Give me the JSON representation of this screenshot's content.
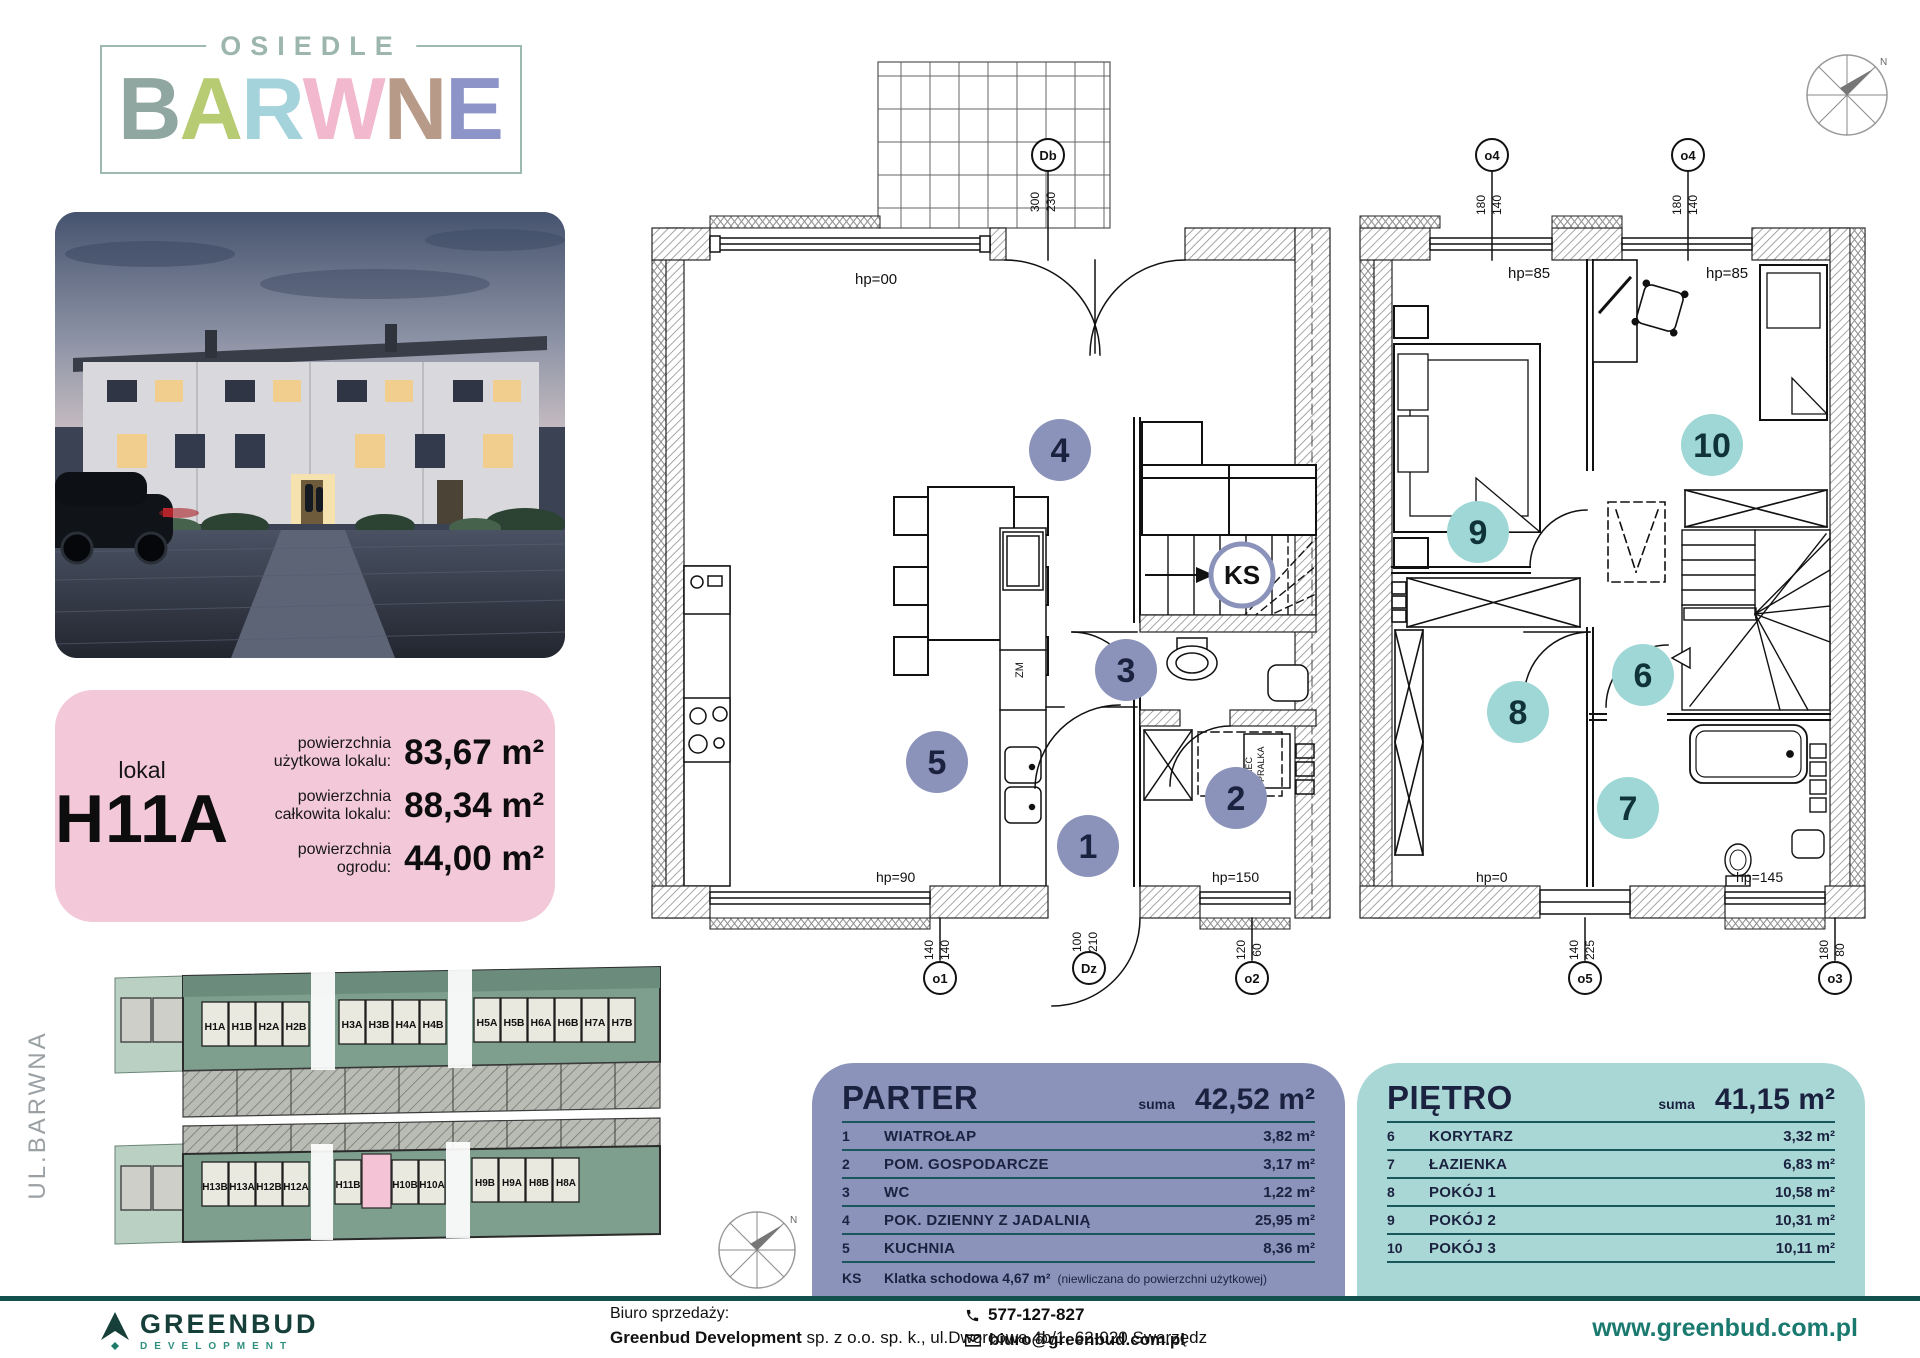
{
  "logo": {
    "osiedle": "OSIEDLE",
    "letters": [
      {
        "t": "B",
        "c": "#8fa7a0"
      },
      {
        "t": "A",
        "c": "#b6cb72"
      },
      {
        "t": "R",
        "c": "#a5d3dc"
      },
      {
        "t": "W",
        "c": "#f1b8ce"
      },
      {
        "t": "N",
        "c": "#b89a88"
      },
      {
        "t": "E",
        "c": "#8d94c8"
      }
    ]
  },
  "card": {
    "lokal": "lokal",
    "unit": "H11A",
    "rows": [
      {
        "l1": "powierzchnia",
        "l2": "użytkowa lokalu:",
        "v": "83,67 m²"
      },
      {
        "l1": "powierzchnia",
        "l2": "całkowita lokalu:",
        "v": "88,34 m²"
      },
      {
        "l1": "powierzchnia",
        "l2": "ogrodu:",
        "v": "44,00 m²"
      }
    ]
  },
  "site": {
    "street": "UL.BARWNA",
    "top": [
      "H1A",
      "H1B",
      "H2A",
      "H2B",
      "H3A",
      "H3B",
      "H4A",
      "H4B",
      "H5A",
      "H5B",
      "H6A",
      "H6B",
      "H7A",
      "H7B"
    ],
    "bottom": [
      "H13B",
      "H13A",
      "H12B",
      "H12A",
      "H11B",
      "H10B",
      "H10A",
      "H9B",
      "H9A",
      "H8B",
      "H8A"
    ],
    "highlight_unit": "H11A"
  },
  "parter_plan": {
    "hp_top": "hp=00",
    "hp_bl": "hp=90",
    "hp_br": "hp=150",
    "db": "Db",
    "db_w": "300",
    "db_h": "230",
    "o1": "o1",
    "o1_w": "140",
    "o1_h": "140",
    "dz": "Dz",
    "dz_w": "100",
    "dz_h": "210",
    "o2": "o2",
    "o2_w": "120",
    "o2_h": "60",
    "r1": "1",
    "r2": "2",
    "r3": "3",
    "r4": "4",
    "r5": "5",
    "ks": "KS",
    "zm": "ZM",
    "pralka": "PRALKA",
    "piec": "PIEC"
  },
  "pietro_plan": {
    "o4": "o4",
    "o4_w": "180",
    "o4_h": "140",
    "hp_tl": "hp=85",
    "hp_tr": "hp=85",
    "hp_bl": "hp=0",
    "hp_br": "hp=145",
    "o5": "o5",
    "o5_w": "140",
    "o5_h": "225",
    "o3": "o3",
    "o3_w": "180",
    "o3_h": "80",
    "r6": "6",
    "r7": "7",
    "r8": "8",
    "r9": "9",
    "r10": "10",
    "n": "N"
  },
  "tables": {
    "parter": {
      "title": "PARTER",
      "suma_label": "suma",
      "suma": "42,52 m²",
      "rows": [
        {
          "no": "1",
          "name": "WIATROŁAP",
          "area": "3,82 m²"
        },
        {
          "no": "2",
          "name": "POM. GOSPODARCZE",
          "area": "3,17 m²"
        },
        {
          "no": "3",
          "name": "WC",
          "area": "1,22 m²"
        },
        {
          "no": "4",
          "name": "POK. DZIENNY Z JADALNIĄ",
          "area": "25,95 m²"
        },
        {
          "no": "5",
          "name": "KUCHNIA",
          "area": "8,36 m²"
        }
      ],
      "ks_no": "KS",
      "ks_name": "Klatka schodowa 4,67 m²",
      "ks_note": "(niewliczana do powierzchni użytkowej)"
    },
    "pietro": {
      "title": "PIĘTRO",
      "suma_label": "suma",
      "suma": "41,15 m²",
      "rows": [
        {
          "no": "6",
          "name": "KORYTARZ",
          "area": "3,32 m²"
        },
        {
          "no": "7",
          "name": "ŁAZIENKA",
          "area": "6,83 m²"
        },
        {
          "no": "8",
          "name": "POKÓJ 1",
          "area": "10,58 m²"
        },
        {
          "no": "9",
          "name": "POKÓJ 2",
          "area": "10,31 m²"
        },
        {
          "no": "10",
          "name": "POKÓJ 3",
          "area": "10,11 m²"
        }
      ]
    }
  },
  "footer": {
    "brand": "GREENBUD",
    "brand_sub": "DEVELOPMENT",
    "office_label": "Biuro sprzedaży:",
    "company": "Greenbud Development",
    "company_rest": " sp. z o.o. sp. k., ul.Dworcowa 4b/1, 62-020 Swarzędz",
    "phone": "577-127-827",
    "email": "biuro@greenbud.com.pl",
    "website": "www.greenbud.com.pl"
  },
  "colors": {
    "pink_card": "#f3c8d9",
    "parter_panel": "#8b93bb",
    "pietro_panel": "#a9d7d5",
    "parter_circle": "#8b93bb",
    "pietro_circle": "#9ed7d6",
    "table_line": "#19565c",
    "footer_accent": "#11504d",
    "brand_green": "#163f39",
    "site_green": "#7e9e8e",
    "highlight_pink": "#f4c3d6"
  }
}
